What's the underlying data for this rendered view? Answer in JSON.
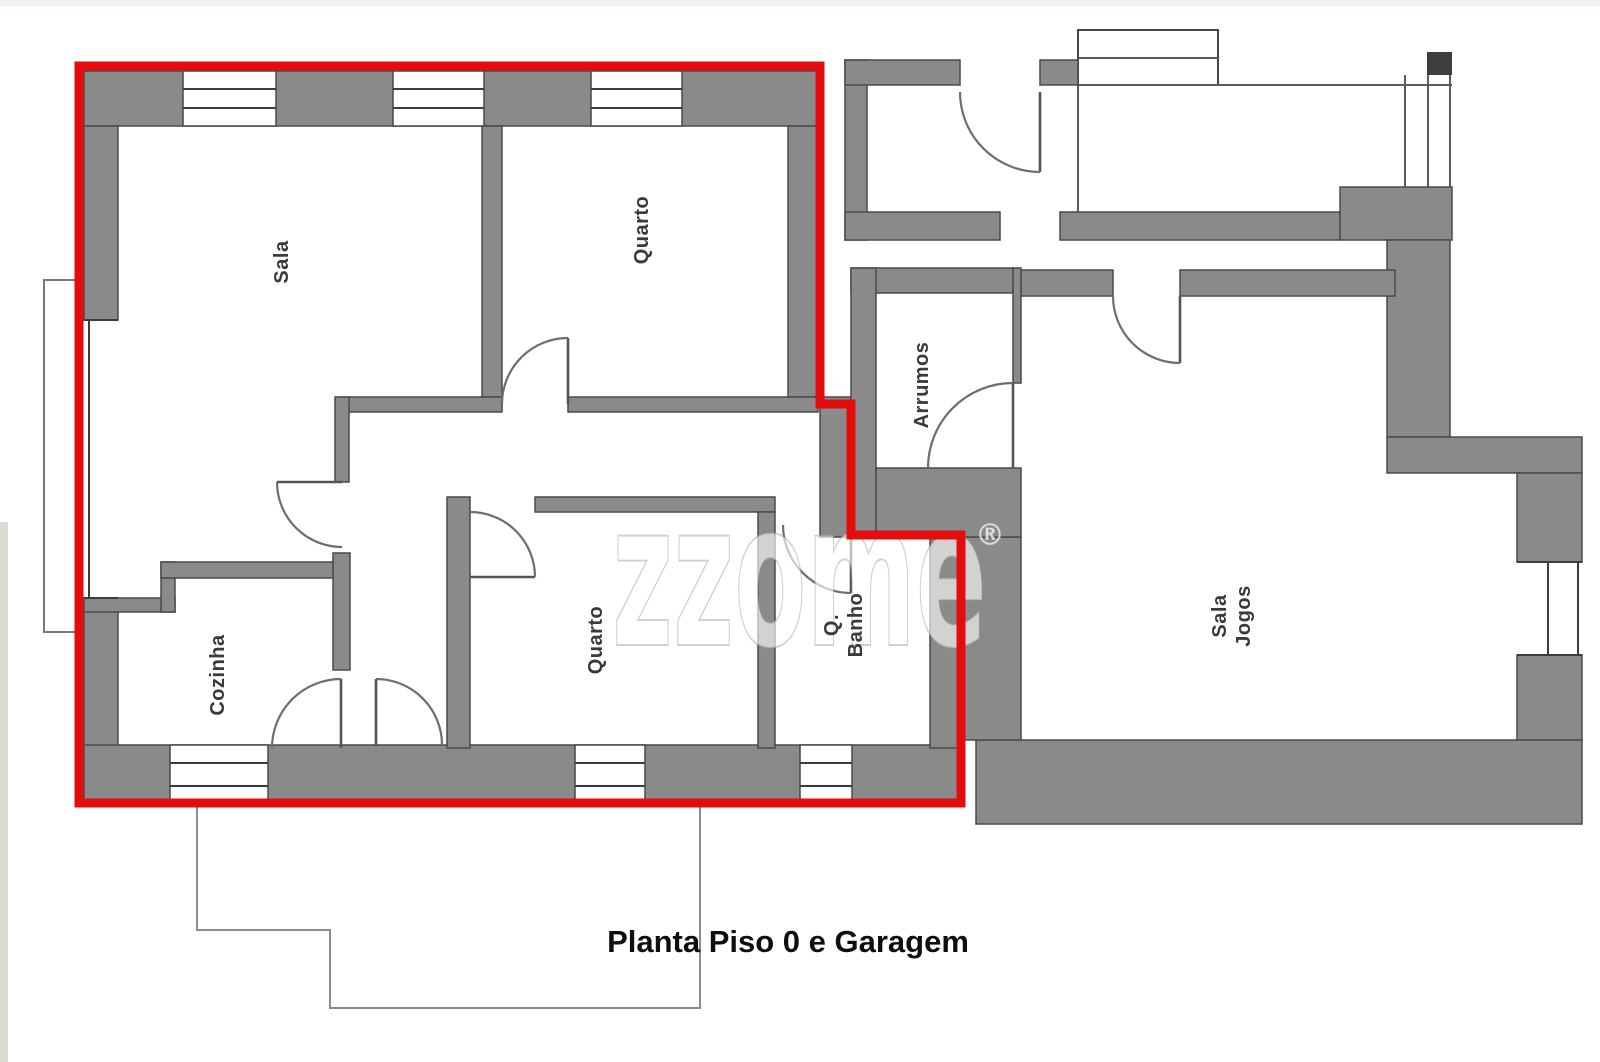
{
  "caption": "Planta Piso 0 e Garagem",
  "watermark": {
    "text": "zzome",
    "registered_mark": "®"
  },
  "rooms": {
    "sala": {
      "label": "Sala"
    },
    "quarto_top": {
      "label": "Quarto"
    },
    "arrumos": {
      "label": "Arrumos"
    },
    "cozinha": {
      "label": "Cozinha"
    },
    "quarto_bottom": {
      "label": "Quarto"
    },
    "banho": {
      "label_line1": "Q.",
      "label_line2": "Banho"
    },
    "sala_jogos": {
      "label_line1": "Sala",
      "label_line2": "Jogos"
    }
  },
  "colors": {
    "highlight_outline_red": "#e30d0d",
    "wall_fill_gray": "#8a8a8a",
    "wall_edge_dark": "#4a4a4a",
    "door_arc_gray": "#6e6e6e"
  }
}
